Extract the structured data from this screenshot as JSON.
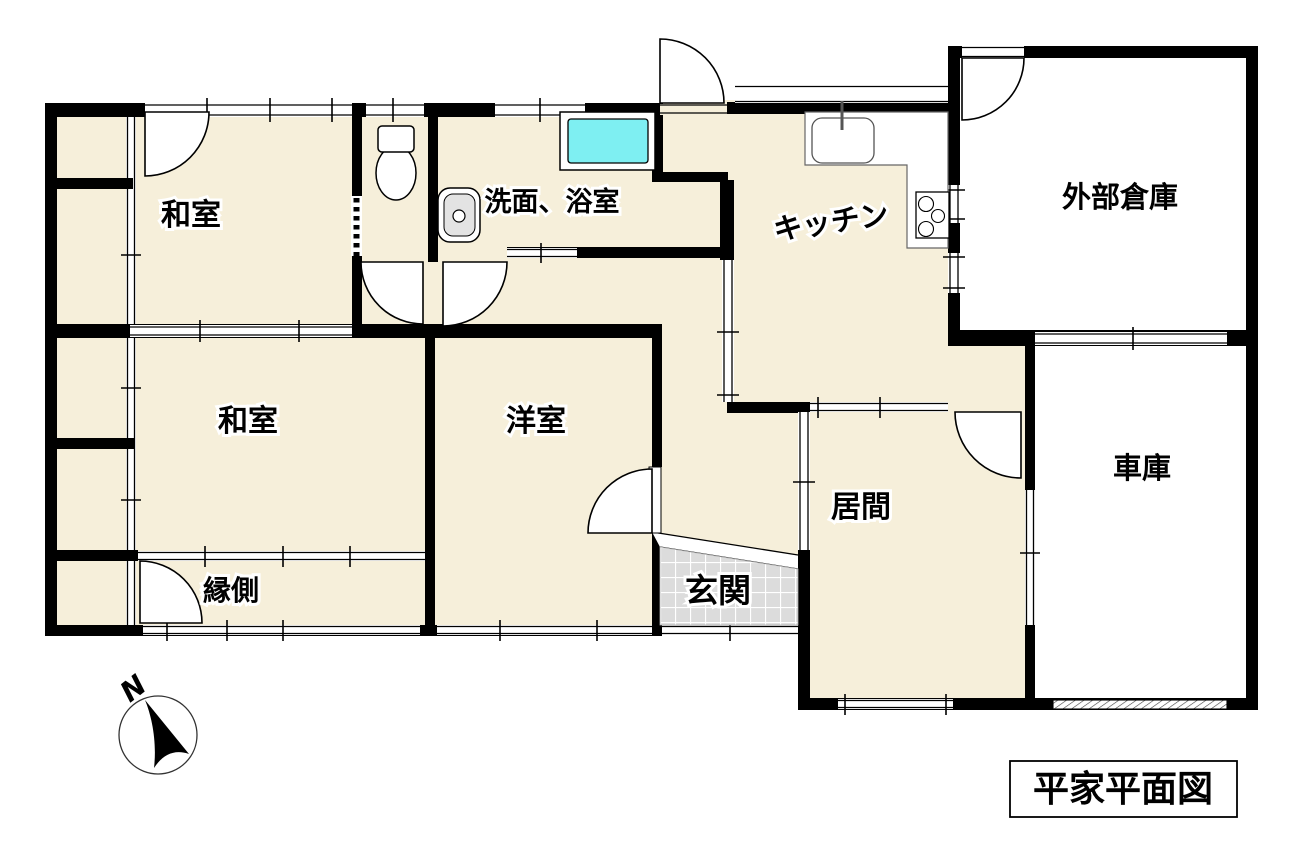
{
  "plan": {
    "title": "平家平面図",
    "compass": {
      "north": "N"
    },
    "rooms": {
      "washitsu_nw": {
        "label": "和室"
      },
      "washitsu_sw": {
        "label": "和室"
      },
      "yoshitsu": {
        "label": "洋室"
      },
      "engawa": {
        "label": "縁側"
      },
      "genkan": {
        "label": "玄関"
      },
      "ima": {
        "label": "居間"
      },
      "kitchen": {
        "label": "キッチン"
      },
      "senmen_yokushitsu": {
        "label": "洗面、浴室"
      },
      "gaibu_souko": {
        "label": "外部倉庫"
      },
      "shako": {
        "label": "車庫"
      }
    },
    "colors": {
      "floor": "#F6EFDA",
      "wall": "#000000",
      "bathtub": "#7EEFF2",
      "entrance_tile": "#DCDCDC",
      "fixture_gray": "#E3E3E3",
      "background": "#FFFFFF"
    }
  }
}
